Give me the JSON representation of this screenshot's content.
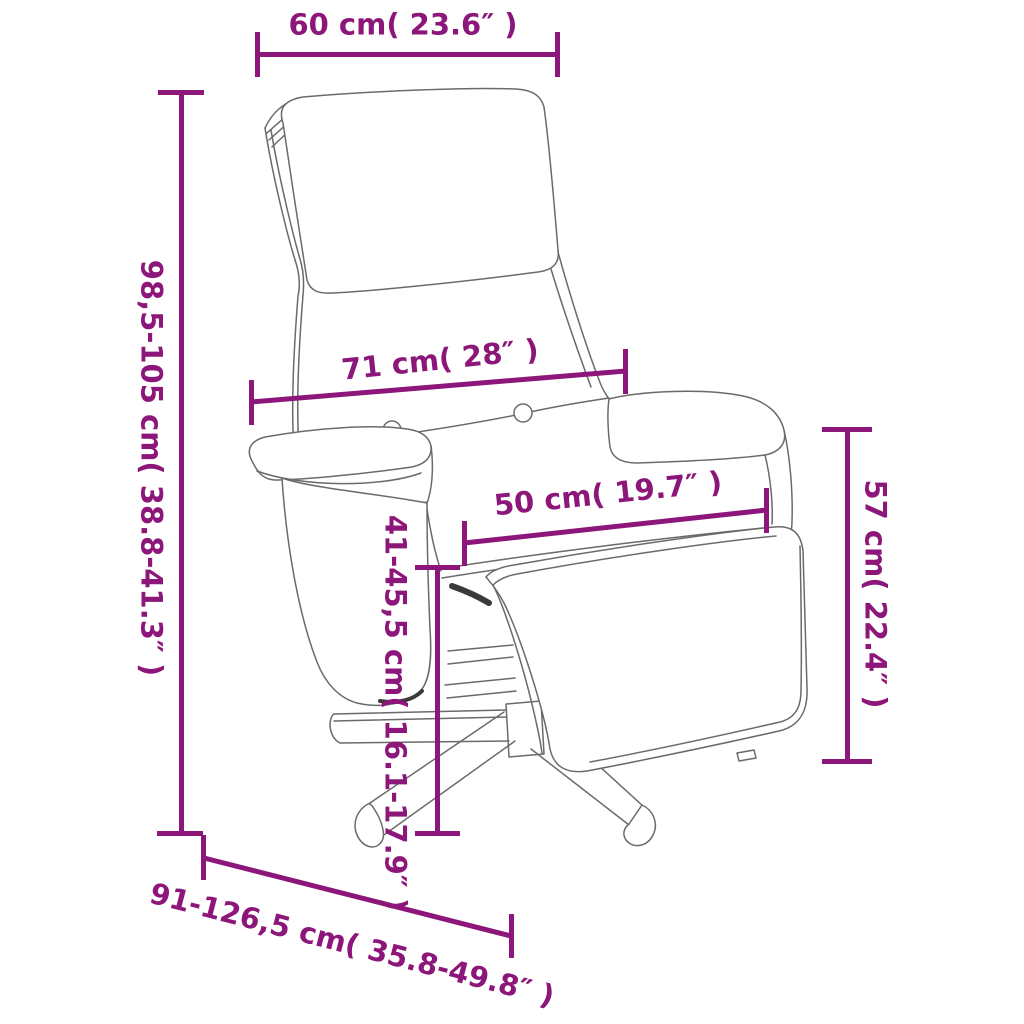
{
  "diagram": {
    "kind": "product-dimension-diagram",
    "product": "recliner-chair-with-footrest",
    "accent_color": "#8C1679",
    "line_art_color": "#6A6A6A",
    "background_color": "#FFFFFF",
    "dimensions": {
      "headrest_width": "60 cm( 23.6″ )",
      "total_height": "98,5-105 cm( 38.8-41.3″ )",
      "backrest_width": "71 cm( 28″ )",
      "seat_width": "50 cm( 19.7″ )",
      "seat_height": "41-45,5 cm( 16.1-17.9″ )",
      "armrest_side_height": "57 cm( 22.4″ )",
      "total_depth": "91-126,5 cm( 35.8-49.8″ )"
    }
  }
}
